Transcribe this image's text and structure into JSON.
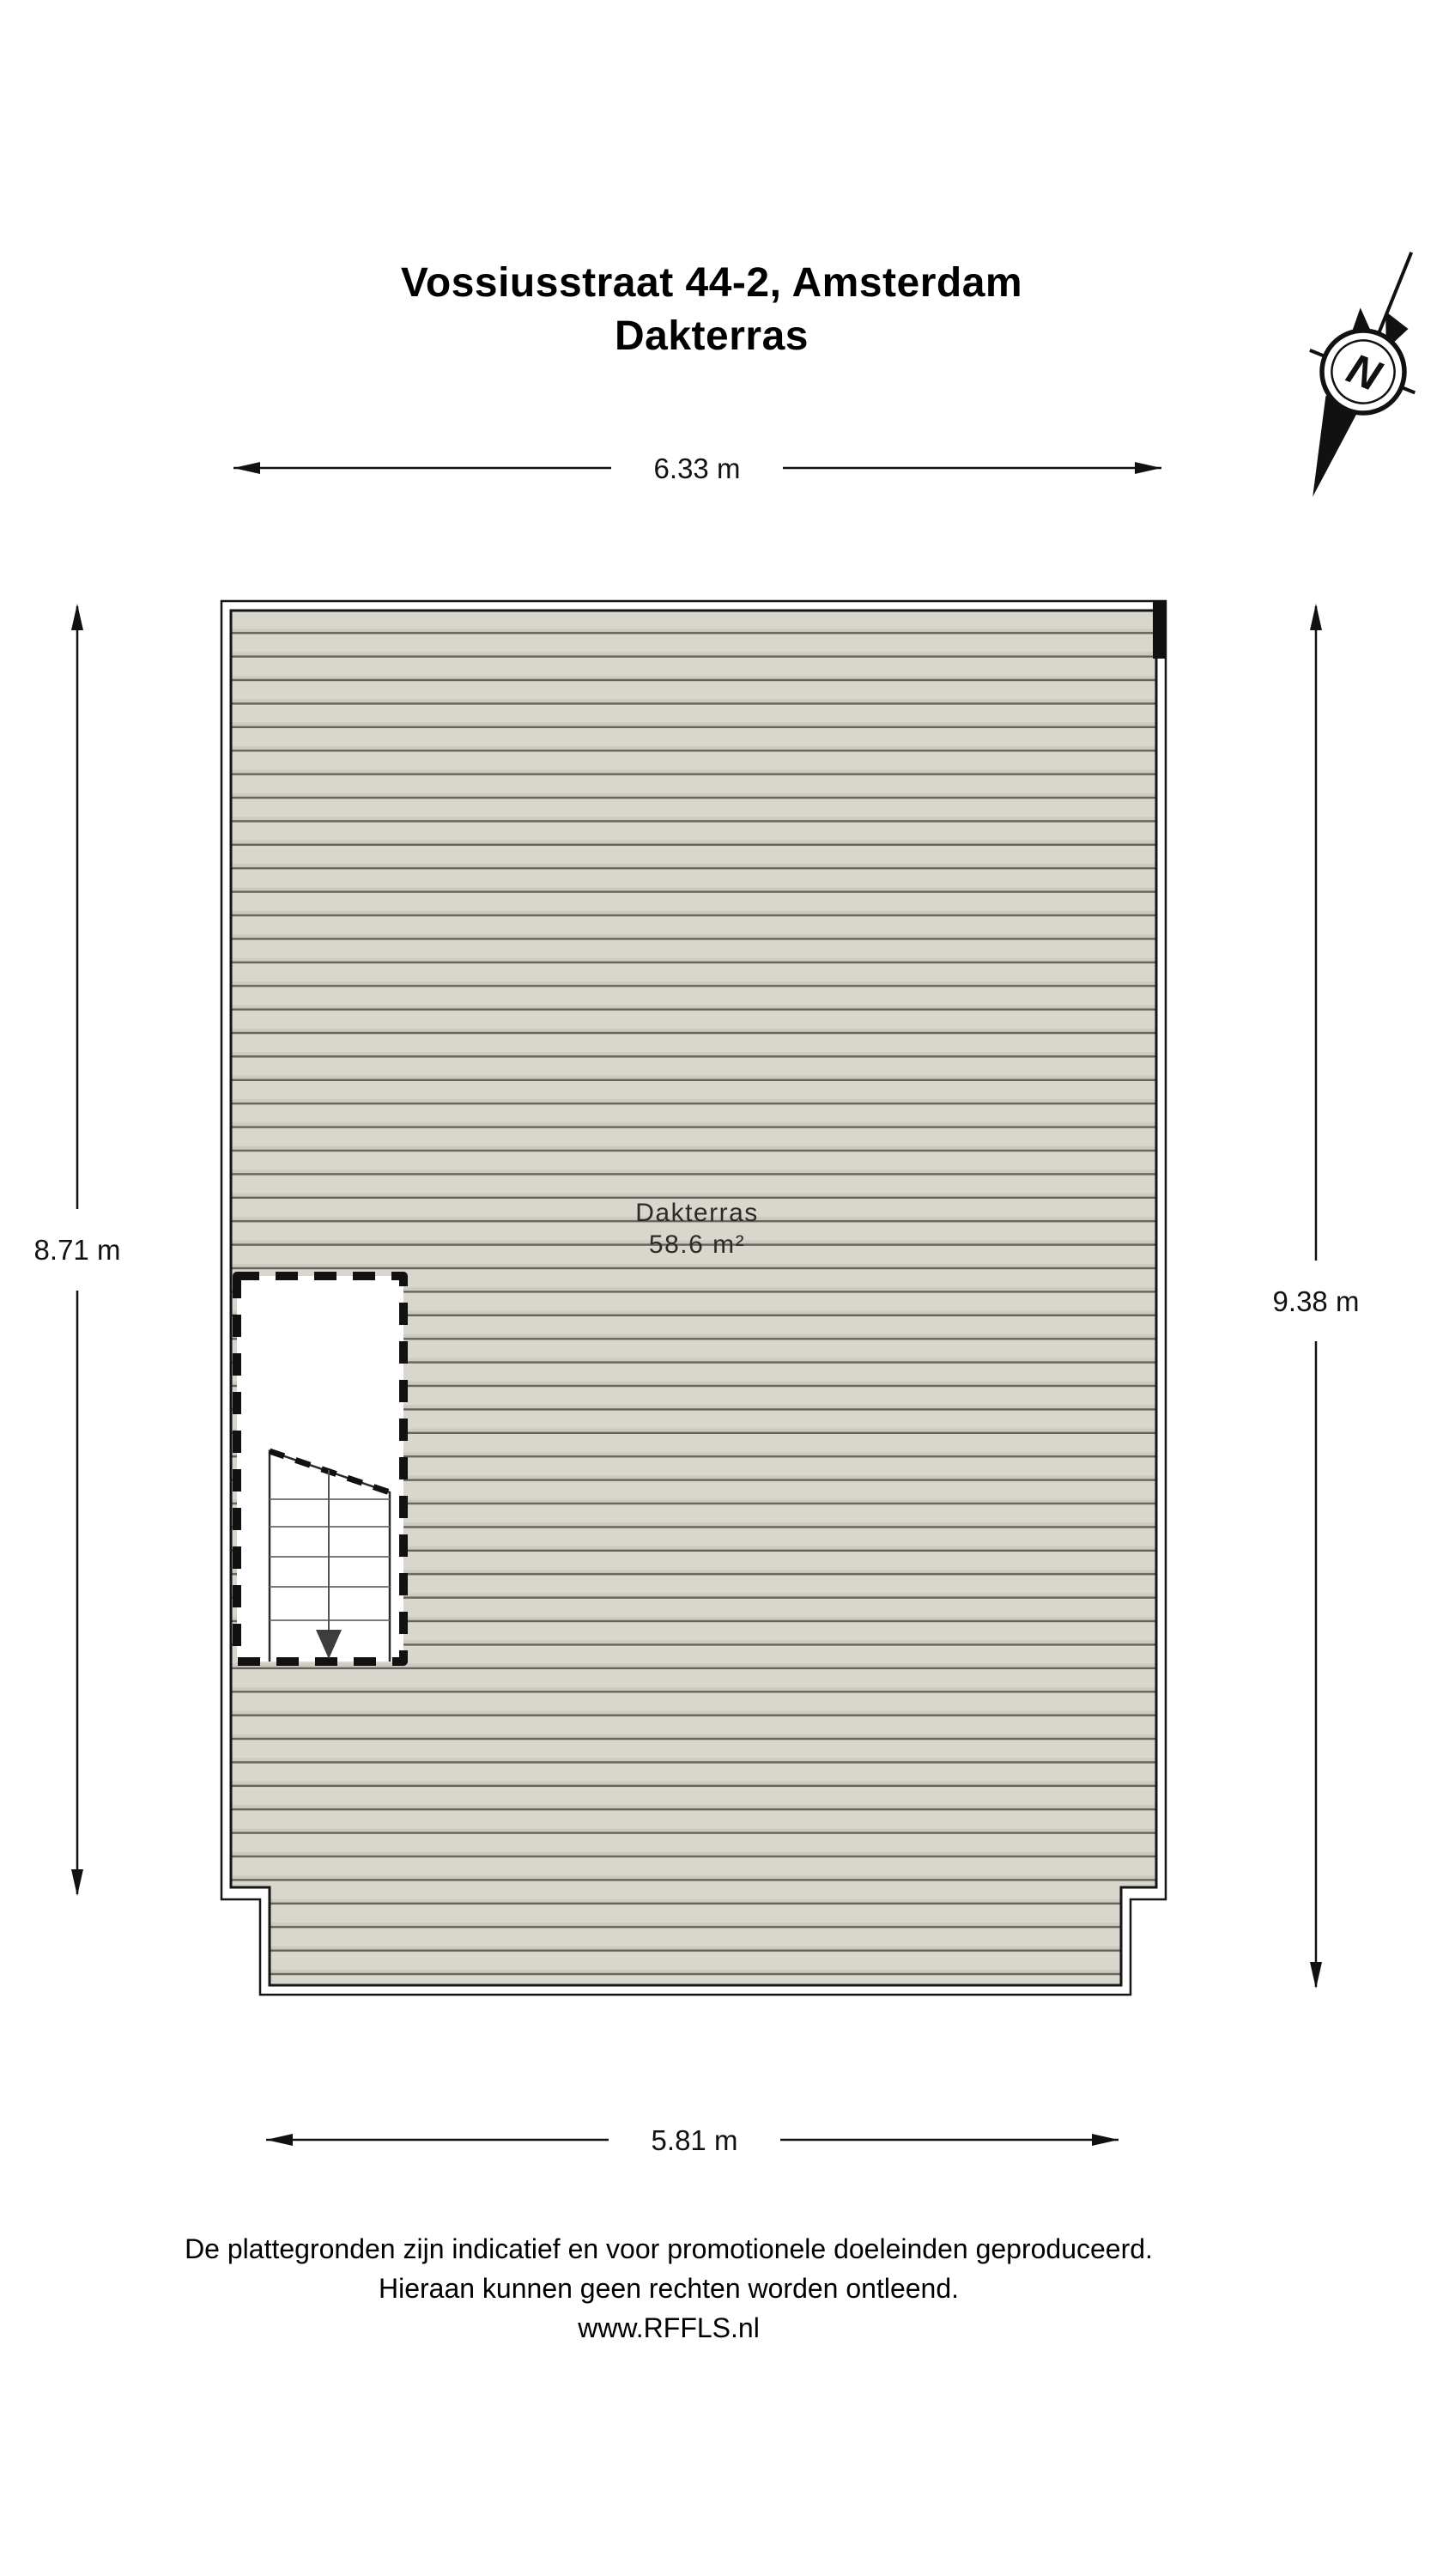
{
  "title": {
    "line1": "Vossiusstraat 44-2, Amsterdam",
    "line2": "Dakterras"
  },
  "compass": {
    "label": "N"
  },
  "dimensions": {
    "top": "6.33 m",
    "left": "8.71 m",
    "right": "9.38 m",
    "bottom": "5.81 m"
  },
  "room": {
    "name": "Dakterras",
    "area": "58.6 m²"
  },
  "footer": {
    "line1": "De plattegronden zijn indicatief en voor promotionele doeleinden geproduceerd.",
    "line2": "Hieraan kunnen geen rechten worden ontleend.",
    "line3": "www.RFFLS.nl"
  },
  "colors": {
    "deck_fill": "#d8d6cd",
    "deck_shade": "#cdcbc1",
    "plank_line": "#64635c",
    "wall_line": "#161616",
    "dash_line": "#111111",
    "stair_line": "#2a2a2a",
    "tread_line": "#6a6a6a",
    "stair_arrow": "#3d3d3d",
    "dimension_line": "#111111",
    "text": "#000000"
  }
}
